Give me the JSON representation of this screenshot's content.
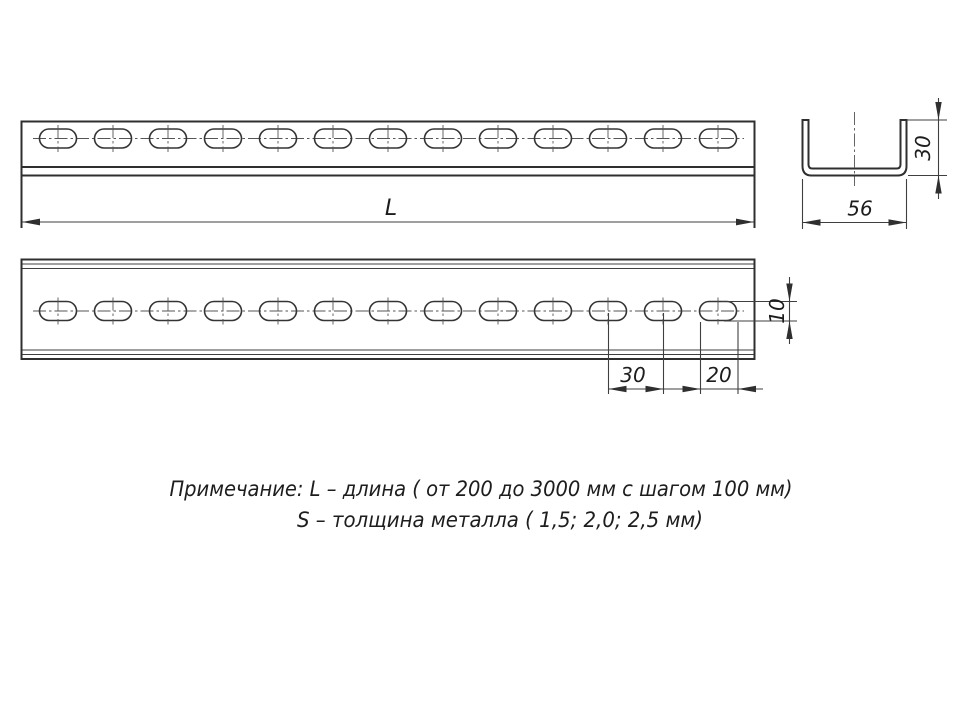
{
  "drawing_type": "technical-drawing-perforated-channel",
  "views": {
    "top": {
      "length_label": "L"
    },
    "section": {
      "width_label": "56",
      "height_label": "30"
    },
    "front": {
      "slot_width_label": "10",
      "slot_pitch_label": "30",
      "slot_length_label": "20"
    }
  },
  "notes": {
    "line1": "Примечание: L – длина ( от 200 до 3000 мм с шагом 100 мм)",
    "line2": "S – толщина металла ( 1,5; 2,0; 2,5 мм)"
  },
  "drawing": {
    "slot_count": 13,
    "first_slot_cx": 58,
    "slot_pitch": 55,
    "slot_w": 37,
    "slot_h": 19,
    "top_view_slot_cy": 138.5,
    "front_view_slot_cy": 311,
    "line_color": "#2f2f2f"
  }
}
